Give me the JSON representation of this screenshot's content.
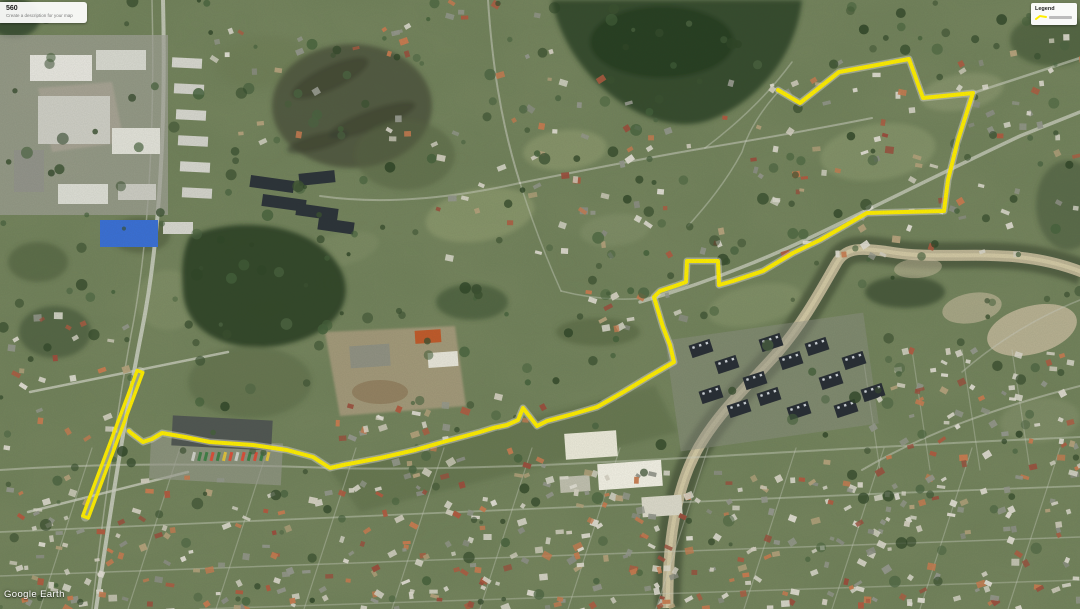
{
  "app": {
    "map_title": "560",
    "map_description_placeholder": "Create a description for your map",
    "attribution": "Google Earth"
  },
  "legend": {
    "title": "Legend",
    "items": [
      {
        "kind": "route-line",
        "color": "#ffee00"
      }
    ]
  },
  "route": {
    "color": "#ffee00",
    "stroke_width": 4,
    "main_points": [
      [
        778,
        90
      ],
      [
        800,
        103
      ],
      [
        839,
        72
      ],
      [
        909,
        59
      ],
      [
        923,
        98
      ],
      [
        973,
        93
      ],
      [
        958,
        140
      ],
      [
        948,
        180
      ],
      [
        944,
        211
      ],
      [
        867,
        213
      ],
      [
        820,
        240
      ],
      [
        793,
        253
      ],
      [
        763,
        271
      ],
      [
        733,
        281
      ],
      [
        719,
        285
      ],
      [
        718,
        261
      ],
      [
        687,
        261
      ],
      [
        686,
        282
      ],
      [
        675,
        286
      ],
      [
        660,
        291
      ],
      [
        654,
        297
      ],
      [
        663,
        327
      ],
      [
        670,
        345
      ],
      [
        674,
        362
      ],
      [
        650,
        376
      ],
      [
        620,
        394
      ],
      [
        597,
        407
      ],
      [
        573,
        414
      ],
      [
        547,
        421
      ],
      [
        537,
        426
      ],
      [
        523,
        408
      ],
      [
        518,
        420
      ],
      [
        507,
        425
      ],
      [
        493,
        428
      ],
      [
        480,
        432
      ],
      [
        443,
        442
      ],
      [
        415,
        450
      ],
      [
        380,
        458
      ],
      [
        343,
        465
      ],
      [
        330,
        468
      ],
      [
        313,
        457
      ],
      [
        287,
        450
      ],
      [
        253,
        445
      ],
      [
        210,
        442
      ],
      [
        185,
        437
      ],
      [
        162,
        433
      ],
      [
        152,
        439
      ],
      [
        143,
        442
      ],
      [
        131,
        433
      ],
      [
        129,
        431
      ]
    ],
    "hairpin": {
      "top_apex": [
        140,
        371.5
      ],
      "bottom_apex": [
        85.5,
        517
      ],
      "half_width": 3
    }
  }
}
